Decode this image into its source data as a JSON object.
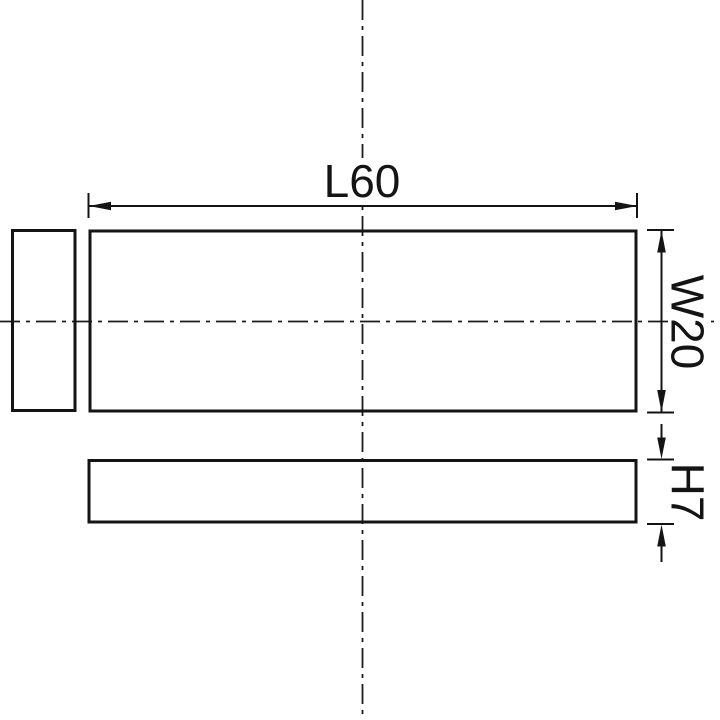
{
  "canvas": {
    "background": "#ffffff",
    "line_color": "#141414"
  },
  "drawing": {
    "dimensions": {
      "length": {
        "label": "L60",
        "value": 60
      },
      "width": {
        "label": "W20",
        "value": 20
      },
      "height": {
        "label": "H7",
        "value": 7
      }
    }
  }
}
